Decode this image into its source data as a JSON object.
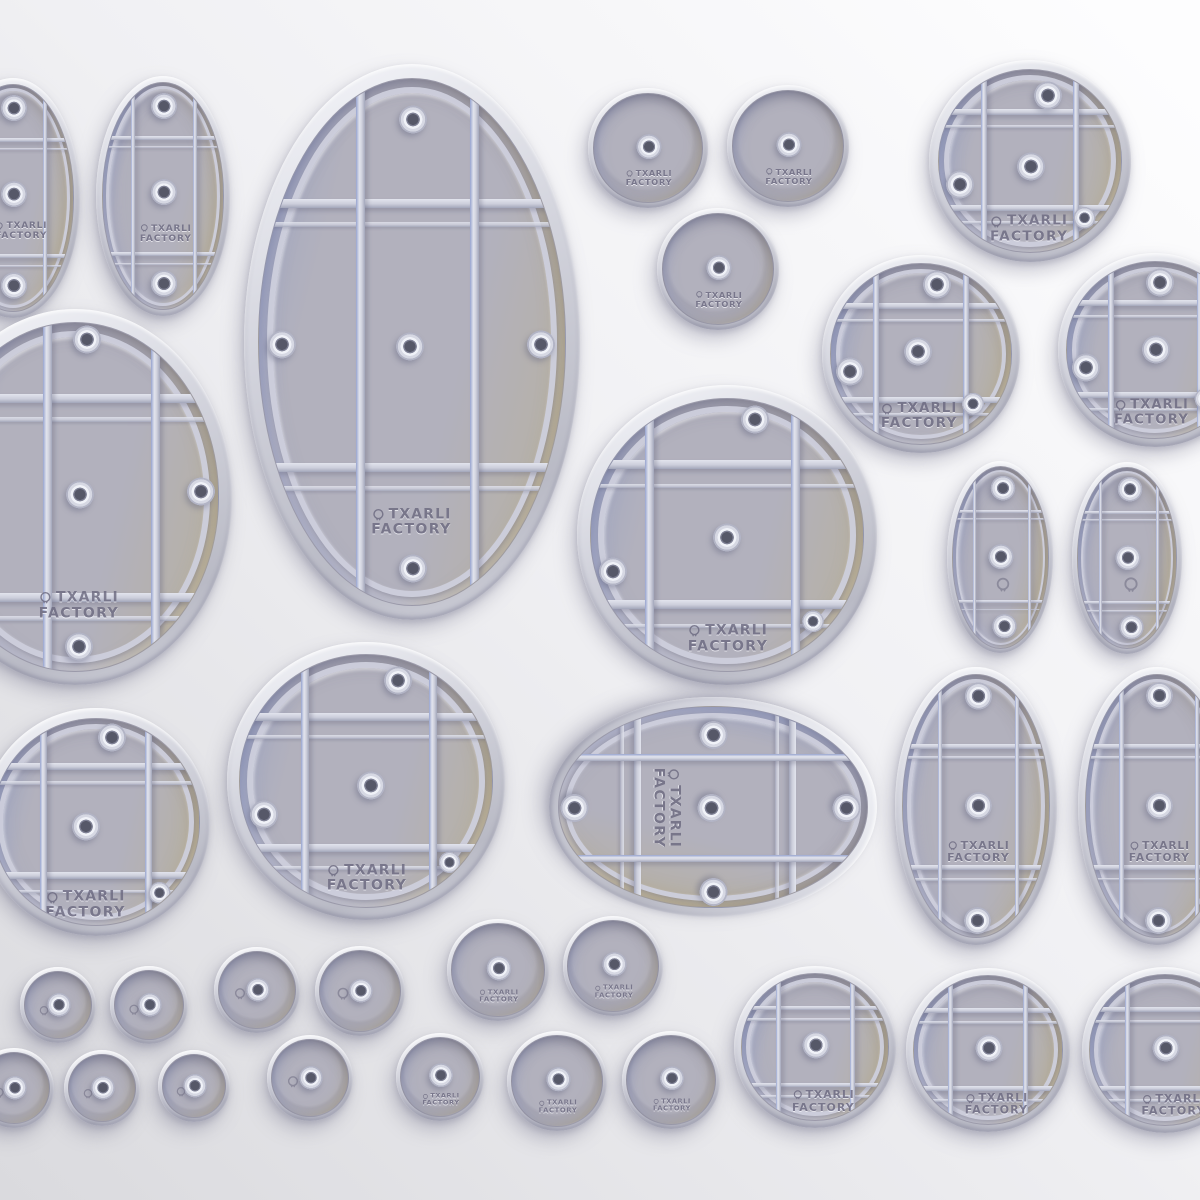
{
  "image": {
    "description": "3D render of a set of tabletop miniature bases (underside view) with support rib grids and magnet hole bosses",
    "background": {
      "from": "#fdfdfe",
      "mid": "#f0f0f3",
      "to": "#dadade"
    }
  },
  "branding": {
    "icon": "alien-head-icon",
    "line1": "TXARLI",
    "line2": "FACTORY"
  },
  "palette": {
    "bg_from": "#fdfdfe",
    "bg_mid": "#f0f0f3",
    "bg_to": "#dadade",
    "rim_highlight": "#f4f5f9",
    "rim_mid": "#d3d4dd",
    "rim_dark": "#b9bac5",
    "floor": "#b2b1bd",
    "floor_blue": "#9fa6c2",
    "floor_tan": "#c3b9a0",
    "rib_highlight": "#e2e4ed",
    "rib_low": "#a2a6ba",
    "rib_blue": "#97a4cf",
    "hole_dark": "#565868",
    "engraving": "#6c6a80",
    "shadow": "rgba(124,124,148,0.40)",
    "shadow_soft": "rgba(124,124,148,0.28)"
  },
  "bases": [
    {
      "name": "oval-base-small-edge-left",
      "kind": "oval",
      "cx": 13,
      "cy": 198,
      "rx": 67,
      "ry": 120,
      "vf": [
        -0.5,
        0.5
      ],
      "hf": [
        -0.52,
        0.5
      ],
      "holes": [
        [
          0,
          -0.78
        ],
        [
          0,
          -0.03
        ],
        [
          0,
          0.77
        ]
      ],
      "logo": "full",
      "lp": [
        0.12,
        0.28
      ]
    },
    {
      "name": "oval-base-small-top",
      "kind": "oval",
      "cx": 163,
      "cy": 196,
      "rx": 67,
      "ry": 120,
      "vf": [
        -0.5,
        0.5
      ],
      "hf": [
        -0.52,
        0.5
      ],
      "holes": [
        [
          0,
          -0.78
        ],
        [
          0,
          -0.03
        ],
        [
          0,
          0.77
        ]
      ],
      "logo": "full",
      "lp": [
        0.03,
        0.32
      ]
    },
    {
      "name": "oval-base-large-top",
      "kind": "oval",
      "cx": 412,
      "cy": 342,
      "rx": 168,
      "ry": 278,
      "vf": [
        -0.34,
        0.4
      ],
      "hf": [
        -0.53,
        0.47
      ],
      "holes": [
        [
          0,
          -0.84
        ],
        [
          -0.85,
          0.01
        ],
        [
          -0.02,
          0.02
        ],
        [
          0.83,
          0.01
        ],
        [
          0,
          0.86
        ]
      ],
      "logo": "full",
      "lp": [
        -0.01,
        0.68
      ]
    },
    {
      "name": "round-base-plain-top-1",
      "kind": "plain",
      "cx": 648,
      "cy": 148,
      "rx": 60,
      "holes": [
        [
          0,
          -0.02
        ]
      ],
      "logo": "full",
      "lp": [
        0,
        0.53
      ]
    },
    {
      "name": "round-base-plain-top-2",
      "kind": "plain",
      "cx": 788,
      "cy": 146,
      "rx": 61,
      "holes": [
        [
          0,
          -0.02
        ]
      ],
      "logo": "full",
      "lp": [
        0,
        0.53
      ]
    },
    {
      "name": "round-base-plain-top-3",
      "kind": "plain",
      "cx": 718,
      "cy": 269,
      "rx": 61,
      "holes": [
        [
          0,
          -0.02
        ]
      ],
      "logo": "full",
      "lp": [
        0,
        0.53
      ]
    },
    {
      "name": "round-base-grid-top-right",
      "kind": "circle",
      "cx": 1030,
      "cy": 161,
      "rx": 101,
      "holes": [
        [
          0.18,
          -0.7
        ],
        [
          -0.77,
          0.26
        ],
        [
          0,
          0.06
        ],
        [
          0.58,
          0.62,
          0.78
        ]
      ],
      "logo": "full",
      "lp": [
        -0.02,
        0.73
      ]
    },
    {
      "name": "round-base-grid-row2-left",
      "kind": "circle",
      "cx": 921,
      "cy": 354,
      "rx": 99,
      "holes": [
        [
          0.17,
          -0.76
        ],
        [
          -0.79,
          0.2
        ],
        [
          -0.04,
          -0.02
        ],
        [
          0.56,
          0.55,
          0.78
        ]
      ],
      "logo": "full",
      "lp": [
        -0.03,
        0.68
      ]
    },
    {
      "name": "round-base-grid-row2-right-cut",
      "kind": "circle",
      "cx": 1155,
      "cy": 350,
      "rx": 97,
      "holes": [
        [
          0.05,
          -0.76
        ],
        [
          -0.79,
          0.2
        ],
        [
          0,
          0
        ],
        [
          0.56,
          0.55,
          0.78
        ]
      ],
      "logo": "full",
      "lp": [
        -0.05,
        0.7
      ]
    },
    {
      "name": "oval-base-large-left-cut",
      "kind": "oval",
      "cx": 75,
      "cy": 497,
      "rx": 157,
      "ry": 188,
      "vf": [
        -0.2,
        0.55
      ],
      "hf": [
        -0.57,
        0.57
      ],
      "holes": [
        [
          0.08,
          -0.9
        ],
        [
          0.03,
          -0.01
        ],
        [
          0.87,
          -0.03
        ],
        [
          0.02,
          0.86
        ]
      ],
      "logo": "full",
      "lp": [
        0.02,
        0.62
      ]
    },
    {
      "name": "round-base-grid-center-large",
      "kind": "circle",
      "cx": 727,
      "cy": 535,
      "rx": 150,
      "vf": [
        -0.57,
        0.49
      ],
      "hf": [
        -0.52,
        0.5
      ],
      "holes": [
        [
          0.2,
          -0.84
        ],
        [
          -0.84,
          0.27
        ],
        [
          -0.01,
          0.02
        ],
        [
          0.62,
          0.63,
          0.78
        ]
      ],
      "logo": "full",
      "lp": [
        0,
        0.75
      ]
    },
    {
      "name": "oval-base-mini-right-1",
      "kind": "oval",
      "cx": 1000,
      "cy": 557,
      "rx": 53,
      "ry": 96,
      "vf": [
        -0.55,
        0.58
      ],
      "hf": [
        -0.51,
        0.48
      ],
      "holes": [
        [
          0.04,
          -0.75
        ],
        [
          0,
          0
        ],
        [
          0.07,
          0.76
        ]
      ],
      "logo": "icon",
      "lp": [
        0.05,
        0.29
      ]
    },
    {
      "name": "oval-base-mini-right-2",
      "kind": "oval",
      "cx": 1127,
      "cy": 558,
      "rx": 55,
      "ry": 96,
      "vf": [
        -0.55,
        0.58
      ],
      "hf": [
        -0.51,
        0.48
      ],
      "holes": [
        [
          0.04,
          -0.75
        ],
        [
          0,
          0
        ],
        [
          0.07,
          0.76
        ]
      ],
      "logo": "icon",
      "lp": [
        0.05,
        0.29
      ]
    },
    {
      "name": "round-base-grid-lower-left-cut",
      "kind": "circle",
      "cx": 96,
      "cy": 822,
      "rx": 114,
      "holes": [
        [
          0.14,
          -0.81
        ],
        [
          -0.11,
          0.05
        ],
        [
          0.6,
          0.68,
          0.78
        ]
      ],
      "logo": "full",
      "lp": [
        -0.11,
        0.79
      ]
    },
    {
      "name": "round-base-grid-lower-left-2",
      "kind": "circle",
      "cx": 366,
      "cy": 781,
      "rx": 139,
      "vf": [
        -0.49,
        0.52
      ],
      "hf": [
        -0.51,
        0.52
      ],
      "holes": [
        [
          0.24,
          -0.79
        ],
        [
          -0.81,
          0.27
        ],
        [
          0.03,
          0.04
        ],
        [
          0.65,
          0.64,
          0.78
        ]
      ],
      "logo": "full",
      "lp": [
        0,
        0.76
      ]
    },
    {
      "name": "oval-base-horizontal-center",
      "kind": "oval",
      "cx": 713,
      "cy": 807,
      "rx": 110,
      "ry": 164,
      "rot": 90,
      "vf": [
        -0.5,
        0.5
      ],
      "hf": [
        -0.52,
        0.48
      ],
      "holes": [
        [
          -0.73,
          0
        ],
        [
          0.83,
          0
        ],
        [
          0,
          -0.86
        ],
        [
          0,
          0.9
        ],
        [
          0,
          0.01
        ]
      ],
      "logo": "full",
      "lp": [
        0,
        0.3
      ]
    },
    {
      "name": "oval-base-medium-right-1",
      "kind": "oval",
      "cx": 976,
      "cy": 806,
      "rx": 81,
      "ry": 139,
      "vf": [
        -0.5,
        0.54
      ],
      "hf": [
        -0.46,
        0.46
      ],
      "holes": [
        [
          0.02,
          -0.83
        ],
        [
          0.02,
          0
        ],
        [
          0.01,
          0.87
        ]
      ],
      "logo": "full",
      "lp": [
        0.02,
        0.34
      ]
    },
    {
      "name": "oval-base-medium-right-2-cut",
      "kind": "oval",
      "cx": 1157,
      "cy": 806,
      "rx": 79,
      "ry": 139,
      "vf": [
        -0.5,
        0.54
      ],
      "hf": [
        -0.46,
        0.46
      ],
      "holes": [
        [
          0.02,
          -0.83
        ],
        [
          0.02,
          0
        ],
        [
          0.01,
          0.87
        ]
      ],
      "logo": "full",
      "lp": [
        0.02,
        0.34
      ]
    },
    {
      "name": "round-base-grid-bottom-1",
      "kind": "circle",
      "cx": 815,
      "cy": 1047,
      "rx": 81,
      "holes": [
        [
          0,
          -0.02
        ]
      ],
      "logo": "full",
      "lp": [
        0.1,
        0.72
      ]
    },
    {
      "name": "round-base-grid-bottom-2",
      "kind": "circle",
      "cx": 988,
      "cy": 1050,
      "rx": 82,
      "holes": [
        [
          0,
          -0.02
        ]
      ],
      "logo": "full",
      "lp": [
        0.1,
        0.72
      ]
    },
    {
      "name": "round-base-grid-bottom-3-cut",
      "kind": "circle",
      "cx": 1165,
      "cy": 1050,
      "rx": 83,
      "holes": [
        [
          0,
          -0.02
        ]
      ],
      "logo": "full",
      "lp": [
        0.1,
        0.72
      ]
    },
    {
      "name": "round-base-mini-a1",
      "kind": "plain",
      "cx": 58,
      "cy": 1005,
      "rx": 38,
      "holes": [
        [
          0,
          0
        ]
      ],
      "logo": "icon",
      "lp": [
        -0.45,
        0.02
      ]
    },
    {
      "name": "round-base-mini-a2",
      "kind": "plain",
      "cx": 149,
      "cy": 1005,
      "rx": 39,
      "holes": [
        [
          0,
          0
        ]
      ],
      "logo": "icon",
      "lp": [
        -0.45,
        0.02
      ]
    },
    {
      "name": "round-base-mini-a3",
      "kind": "plain",
      "cx": 257,
      "cy": 990,
      "rx": 43,
      "holes": [
        [
          0,
          0
        ]
      ],
      "logo": "icon",
      "lp": [
        -0.45,
        0.02
      ]
    },
    {
      "name": "round-base-mini-a4",
      "kind": "plain",
      "cx": 360,
      "cy": 991,
      "rx": 45,
      "holes": [
        [
          0,
          0
        ]
      ],
      "logo": "icon",
      "lp": [
        -0.45,
        0.02
      ]
    },
    {
      "name": "round-base-small-a5",
      "kind": "plain",
      "cx": 498,
      "cy": 970,
      "rx": 51,
      "holes": [
        [
          0,
          -0.04
        ]
      ],
      "logo": "full",
      "lp": [
        0,
        0.55
      ]
    },
    {
      "name": "round-base-small-a6",
      "kind": "plain",
      "cx": 613,
      "cy": 966,
      "rx": 50,
      "holes": [
        [
          0,
          -0.04
        ]
      ],
      "logo": "full",
      "lp": [
        0,
        0.55
      ]
    },
    {
      "name": "round-base-mini-b1-cut",
      "kind": "plain",
      "cx": 14,
      "cy": 1088,
      "rx": 40,
      "holes": [
        [
          0,
          0
        ]
      ],
      "logo": "icon",
      "lp": [
        -0.45,
        0.02
      ]
    },
    {
      "name": "round-base-mini-b2",
      "kind": "plain",
      "cx": 102,
      "cy": 1088,
      "rx": 38,
      "holes": [
        [
          0,
          0
        ]
      ],
      "logo": "icon",
      "lp": [
        -0.45,
        0.02
      ]
    },
    {
      "name": "round-base-mini-b3",
      "kind": "plain",
      "cx": 194,
      "cy": 1086,
      "rx": 36,
      "holes": [
        [
          0,
          0
        ]
      ],
      "logo": "icon",
      "lp": [
        -0.45,
        0.02
      ]
    },
    {
      "name": "round-base-mini-b4",
      "kind": "plain",
      "cx": 310,
      "cy": 1078,
      "rx": 43,
      "holes": [
        [
          0,
          0
        ]
      ],
      "logo": "icon",
      "lp": [
        -0.45,
        0.02
      ]
    },
    {
      "name": "round-base-small-b5",
      "kind": "plain",
      "cx": 440,
      "cy": 1077,
      "rx": 44,
      "holes": [
        [
          0,
          -0.04
        ]
      ],
      "logo": "full",
      "lp": [
        0,
        0.55
      ]
    },
    {
      "name": "round-base-small-b6",
      "kind": "plain",
      "cx": 557,
      "cy": 1081,
      "rx": 50,
      "holes": [
        [
          0,
          -0.04
        ]
      ],
      "logo": "full",
      "lp": [
        0,
        0.55
      ]
    },
    {
      "name": "round-base-small-b7",
      "kind": "plain",
      "cx": 671,
      "cy": 1080,
      "rx": 49,
      "holes": [
        [
          0,
          -0.04
        ]
      ],
      "logo": "full",
      "lp": [
        0,
        0.55
      ]
    }
  ]
}
